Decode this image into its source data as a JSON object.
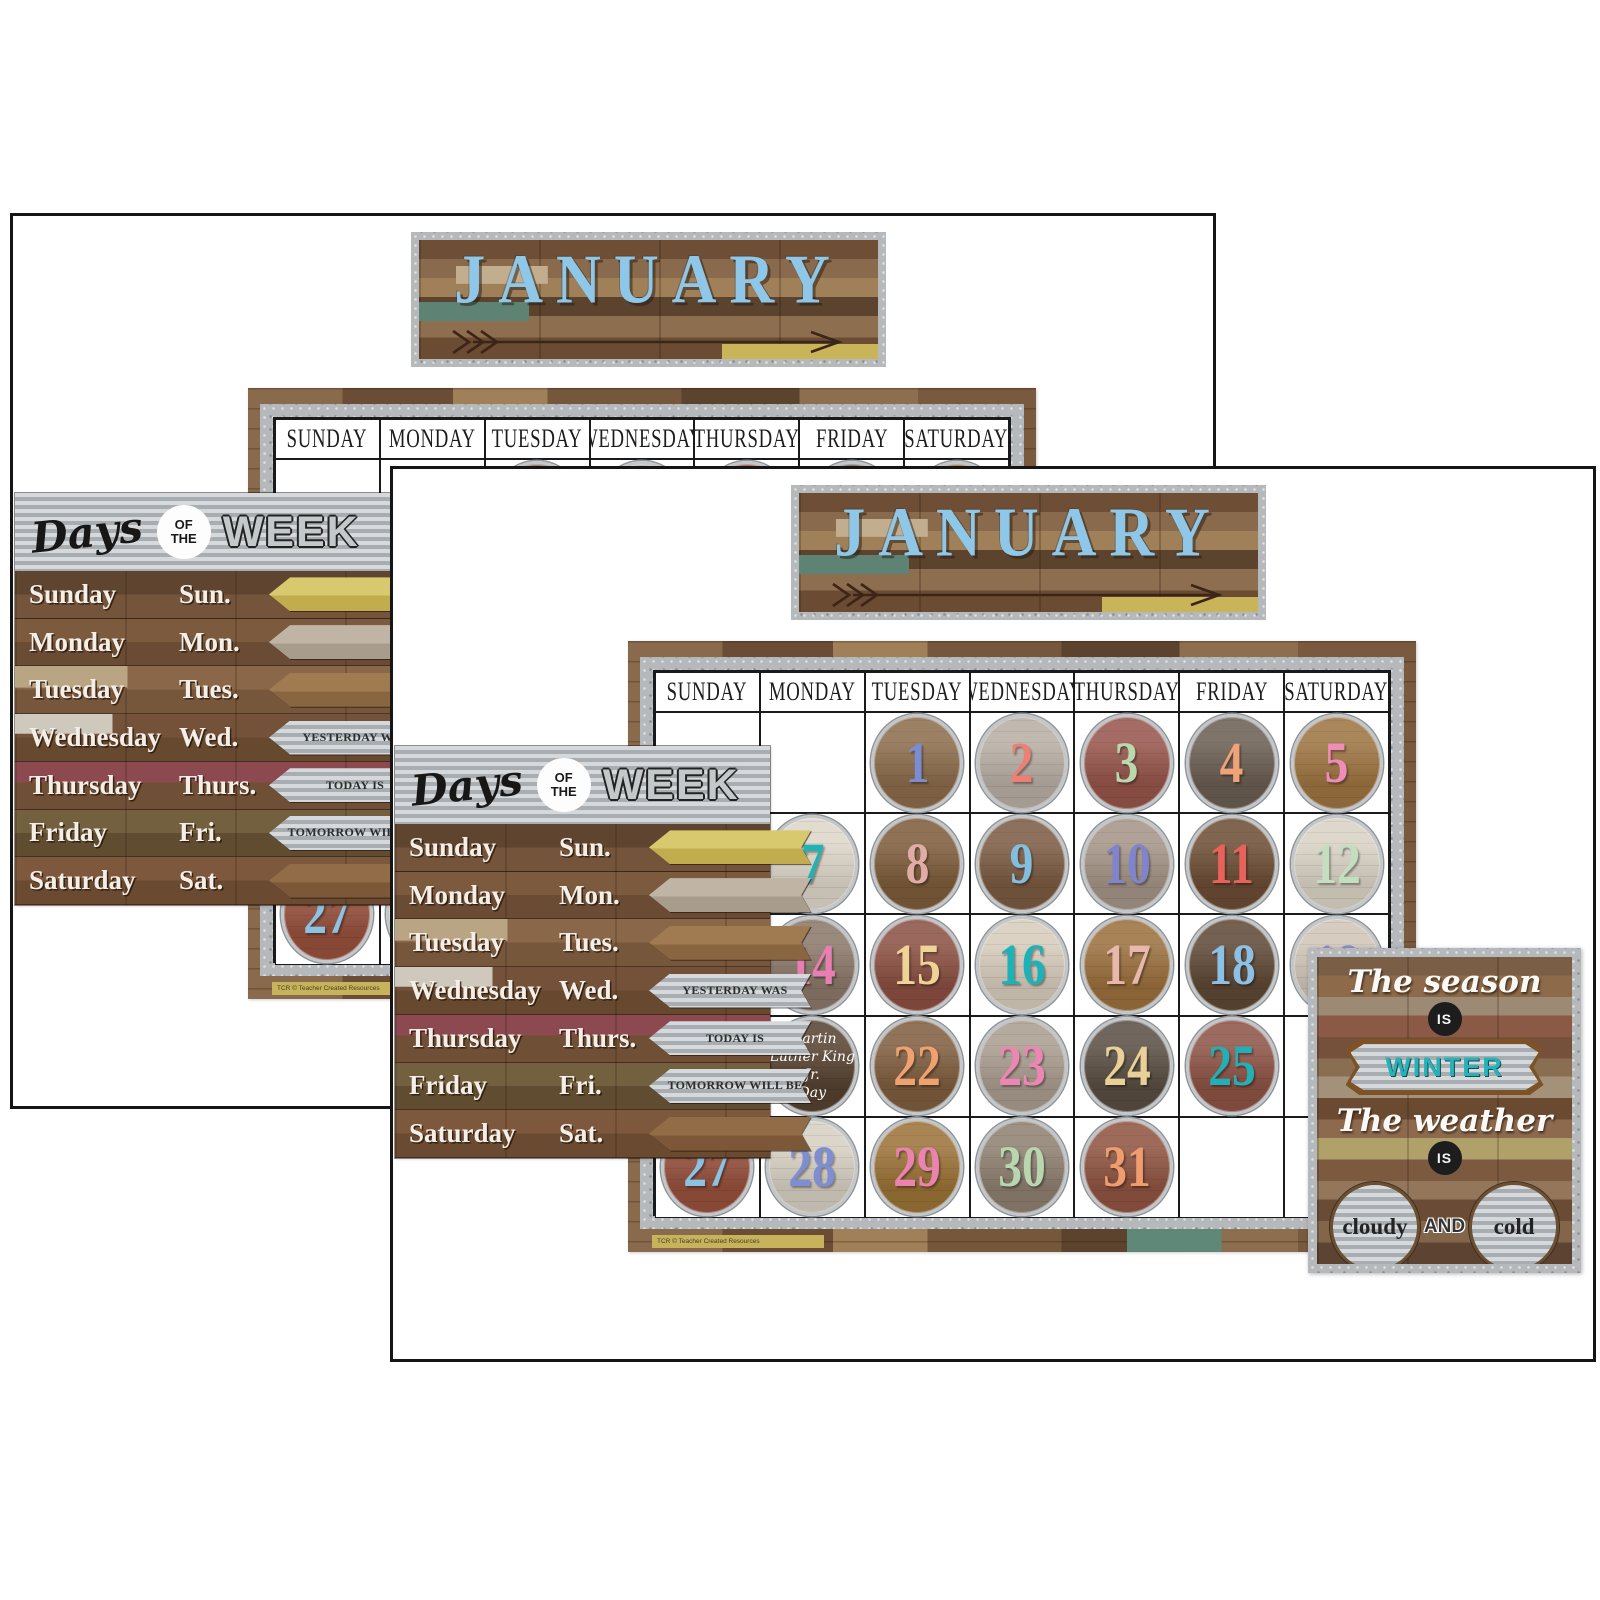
{
  "product": {
    "month": "JANUARY",
    "weekday_headers": [
      "SUNDAY",
      "MONDAY",
      "TUESDAY",
      "WEDNESDAY",
      "THURSDAY",
      "FRIDAY",
      "SATURDAY"
    ],
    "days_chart": {
      "title_script": "Days",
      "title_of": "OF",
      "title_the": "THE",
      "title_week": "WEEK",
      "rows": [
        {
          "day": "Sunday",
          "abbr": "Sun.",
          "arrow": ""
        },
        {
          "day": "Monday",
          "abbr": "Mon.",
          "arrow": ""
        },
        {
          "day": "Tuesday",
          "abbr": "Tues.",
          "arrow": ""
        },
        {
          "day": "Wednesday",
          "abbr": "Wed.",
          "arrow": "YESTERDAY WAS"
        },
        {
          "day": "Thursday",
          "abbr": "Thurs.",
          "arrow": "TODAY IS"
        },
        {
          "day": "Friday",
          "abbr": "Fri.",
          "arrow": "TOMORROW WILL BE"
        },
        {
          "day": "Saturday",
          "abbr": "Sat.",
          "arrow": ""
        }
      ]
    },
    "calendar": {
      "rows": [
        [
          null,
          null,
          {
            "n": "1",
            "fg": "#7a8cd2",
            "bg": "#8b6b4b"
          },
          {
            "n": "2",
            "fg": "#ee7f74",
            "bg": "#b7aea3"
          },
          {
            "n": "3",
            "fg": "#b9d8ae",
            "bg": "#95544a"
          },
          {
            "n": "4",
            "fg": "#efa377",
            "bg": "#6a5d51"
          },
          {
            "n": "5",
            "fg": "#ef8cba",
            "bg": "#9c7340"
          }
        ],
        [
          null,
          {
            "n": "7",
            "fg": "#21b3b3",
            "bg": "#ddd5c8"
          },
          {
            "n": "8",
            "fg": "#e2aca6",
            "bg": "#7d5b3a"
          },
          {
            "n": "9",
            "fg": "#84bede",
            "bg": "#7b5a41"
          },
          {
            "n": "10",
            "fg": "#8084cc",
            "bg": "#a39385"
          },
          {
            "n": "11",
            "fg": "#e8625a",
            "bg": "#6b4c34"
          },
          {
            "n": "12",
            "fg": "#c4dfc0",
            "bg": "#d9d2c4"
          }
        ],
        [
          null,
          {
            "n": "14",
            "fg": "#e87fb2",
            "bg": "#8a7768"
          },
          {
            "n": "15",
            "fg": "#eed396",
            "bg": "#8a4f41"
          },
          {
            "n": "16",
            "fg": "#1cb2b8",
            "bg": "#d6cbbb"
          },
          {
            "n": "17",
            "fg": "#e9b8ac",
            "bg": "#9a6f3d"
          },
          {
            "n": "18",
            "fg": "#8cc0e4",
            "bg": "#5e4734"
          },
          {
            "n": "19",
            "fg": "#8a90d4",
            "bg": "#cfc5b6"
          }
        ],
        [
          null,
          {
            "holiday": [
              "Martin",
              "Luther King Jr.",
              "Day"
            ],
            "bg": "#55412f"
          },
          {
            "n": "22",
            "fg": "#efa170",
            "bg": "#7e5c3e"
          },
          {
            "n": "23",
            "fg": "#ee86b4",
            "bg": "#a99c8e"
          },
          {
            "n": "24",
            "fg": "#e8d098",
            "bg": "#584d42"
          },
          {
            "n": "25",
            "fg": "#22b0b6",
            "bg": "#8c5244"
          },
          null
        ],
        [
          {
            "n": "27",
            "fg": "#8cc2e2",
            "bg": "#96503c"
          },
          {
            "n": "28",
            "fg": "#7e8ed2",
            "bg": "#d6cfc2"
          },
          {
            "n": "29",
            "fg": "#ea83b0",
            "bg": "#9a7136"
          },
          {
            "n": "30",
            "fg": "#b8d6b0",
            "bg": "#8d7f70"
          },
          {
            "n": "31",
            "fg": "#ef9d6e",
            "bg": "#8e5340"
          },
          null,
          null
        ]
      ]
    },
    "weather_chart": {
      "line1": "The season",
      "is1": "IS",
      "season": "WINTER",
      "line2": "The weather",
      "is2": "IS",
      "condition1": "cloudy",
      "conjunction": "AND",
      "condition2": "cold"
    },
    "fine_print": "TCR © Teacher Created Resources",
    "colors": {
      "month_letters": "#8ec7e8",
      "winter_teal": "#25b2b8",
      "metal": "#b5b9bc",
      "page_border": "#151515"
    }
  }
}
